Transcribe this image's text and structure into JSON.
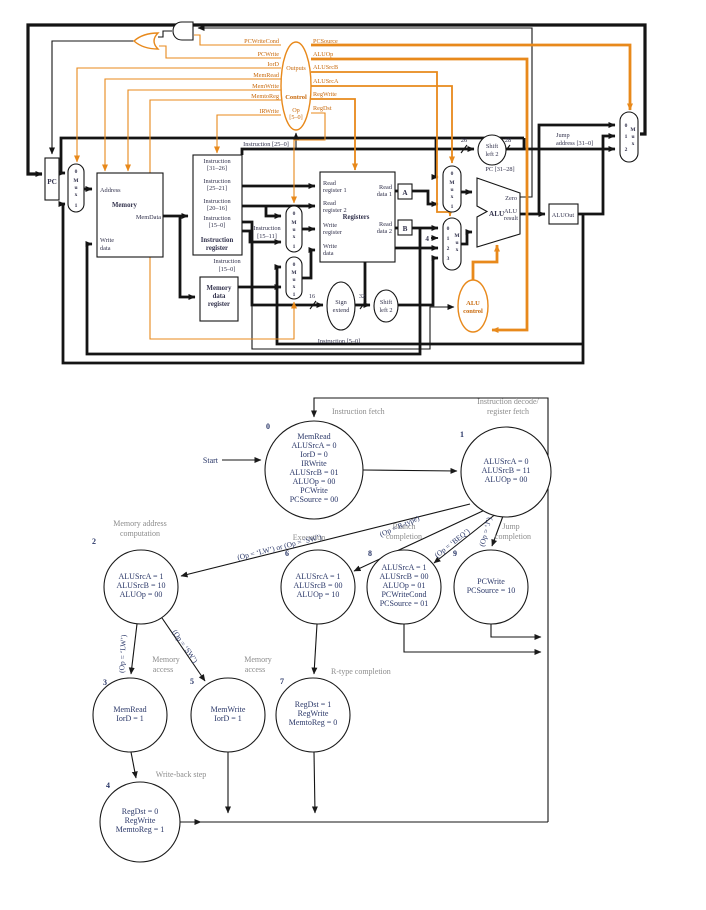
{
  "colors": {
    "accent": "#E8891B",
    "fsm_text": "#2A3768",
    "section_label": "#8C8C8C",
    "wire": "#141414"
  },
  "dp": {
    "pc": "PC",
    "mux": {
      "m": "M",
      "u": "u",
      "x": "x",
      "n0": "0",
      "n1": "1",
      "n2": "2",
      "n3": "3"
    },
    "memory": {
      "address": "Address",
      "title": "Memory",
      "memdata": "MemData",
      "w1": "Write",
      "w2": "data"
    },
    "ir": {
      "i": "Instruction",
      "b1": "[31–26]",
      "b2": "[25–21]",
      "b3": "[20–16]",
      "b4": "[15–0]",
      "t1": "Instruction",
      "t2": "register"
    },
    "mdr": {
      "l1": "Memory",
      "l2": "data",
      "l3": "register"
    },
    "regs": {
      "read": "Read",
      "write": "Write",
      "r1": "register 1",
      "r2": "register 2",
      "title": "Registers",
      "reg": "register",
      "data": "data",
      "d1": "data 1",
      "d2": "data 2"
    },
    "a": "A",
    "b": "B",
    "four": "4",
    "alu": {
      "title": "ALU",
      "zero": "Zero",
      "r1": "ALU",
      "r2": "result"
    },
    "aluout": "ALUOut",
    "shift": {
      "l1": "Shift",
      "l2": "left 2"
    },
    "sign": {
      "l1": "Sign",
      "l2": "extend"
    },
    "aluctl": {
      "l1": "ALU",
      "l2": "control"
    },
    "control": {
      "title": "Control",
      "outputs": "Outputs",
      "op": "Op",
      "opbits": "[5–0]",
      "left": [
        "PCWriteCond",
        "PCWrite",
        "IorD",
        "MemRead",
        "MemWrite",
        "MemtoReg",
        "IRWrite"
      ],
      "right": [
        "PCSource",
        "ALUOp",
        "ALUSrcB",
        "ALUSrcA",
        "RegWrite",
        "RegDst"
      ]
    },
    "labels": {
      "i250": "Instruction [25–0]",
      "i1511a": "Instruction",
      "i1511b": "[15–11]",
      "i150a": "Instruction",
      "i150b": "[15–0]",
      "i50": "Instruction [5–0]",
      "pc3128": "PC [31–28]",
      "jump1": "Jump",
      "jump2": "address [31–0]",
      "n16": "16",
      "n32": "32",
      "n26": "26",
      "n28": "28"
    }
  },
  "fsm": {
    "start": "Start",
    "states": {
      "s0": {
        "n": "0",
        "name1": "Instruction fetch",
        "lines": [
          "MemRead",
          "ALUSrcA = 0",
          "IorD = 0",
          "IRWrite",
          "ALUSrcB = 01",
          "ALUOp = 00",
          "PCWrite",
          "PCSource = 00"
        ]
      },
      "s1": {
        "n": "1",
        "name1": "Instruction decode/",
        "name2": "register fetch",
        "lines": [
          "ALUSrcA = 0",
          "ALUSrcB = 11",
          "ALUOp = 00"
        ]
      },
      "s2": {
        "n": "2",
        "name1": "Memory address",
        "name2": "computation",
        "lines": [
          "ALUSrcA = 1",
          "ALUSrcB = 10",
          "ALUOp = 00"
        ]
      },
      "s6": {
        "n": "6",
        "name1": "Execution",
        "lines": [
          "ALUSrcA = 1",
          "ALUSrcB = 00",
          "ALUOp = 10"
        ]
      },
      "s8": {
        "n": "8",
        "name1": "Branch",
        "name2": "completion",
        "lines": [
          "ALUSrcA = 1",
          "ALUSrcB = 00",
          "ALUOp = 01",
          "PCWriteCond",
          "PCSource = 01"
        ]
      },
      "s9": {
        "n": "9",
        "name1": "Jump",
        "name2": "completion",
        "lines": [
          "PCWrite",
          "PCSource = 10"
        ]
      },
      "s3": {
        "n": "3",
        "name1": "Memory",
        "name2": "access",
        "lines": [
          "MemRead",
          "IorD = 1"
        ]
      },
      "s5": {
        "n": "5",
        "name1": "Memory",
        "name2": "access",
        "lines": [
          "MemWrite",
          "IorD = 1"
        ]
      },
      "s7": {
        "n": "7",
        "name1": "R-type completion",
        "lines": [
          "RegDst = 1",
          "RegWrite",
          "MemtoReg = 0"
        ]
      },
      "s4": {
        "n": "4",
        "name1": "Write-back step",
        "lines": [
          "RegDst = 0",
          "RegWrite",
          "MemtoReg = 1"
        ]
      }
    },
    "edges": {
      "lwsw": "(Op = ‘LW’) or (Op = ‘SW’)",
      "rtype": "(Op = R-type)",
      "beq": "(Op = ‘BEQ’)",
      "j": "(Op = ‘J’)",
      "lw": "(Op = ‘LW’)",
      "sw": "(Op = ‘SW’)"
    }
  }
}
